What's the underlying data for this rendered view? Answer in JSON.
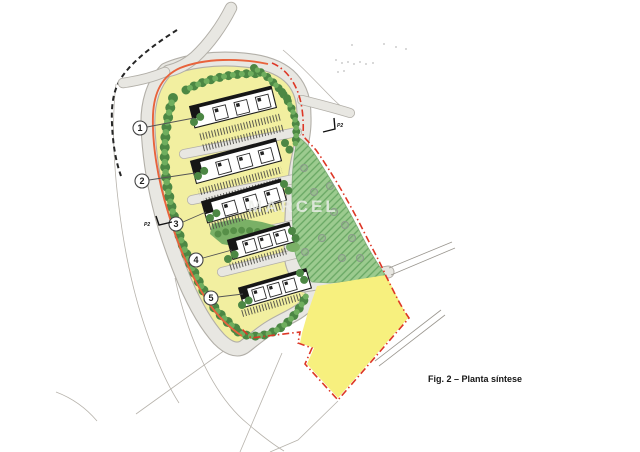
{
  "figure_caption": "Fig. 2 – Planta síntese",
  "watermark_text": "MARCEL",
  "plan": {
    "unit_markers": [
      {
        "label": "1"
      },
      {
        "label": "2"
      },
      {
        "label": "3"
      },
      {
        "label": "4"
      },
      {
        "label": "5"
      }
    ],
    "section_markers": [
      {
        "label": "P2"
      },
      {
        "label": "P2"
      }
    ],
    "colors": {
      "site_green": "#9ccb8f",
      "site_green_hatch": "#68a763",
      "green_edge": "#7fae77",
      "site_yellow": "#f7f07e",
      "site_yellow_edge": "#cfc65e",
      "island_yellow": "#f2efa0",
      "ne_strip_yellow": "#ece789",
      "boundary_red": "#dd3726",
      "boundary_orange": "#e8633c",
      "tree_dark": "#4c8744",
      "tree_light": "#6fae5e",
      "shrub_green": "#7ab066",
      "shrub_texture": "#578f48",
      "green_tree_ring": "#8a9a8a"
    }
  }
}
